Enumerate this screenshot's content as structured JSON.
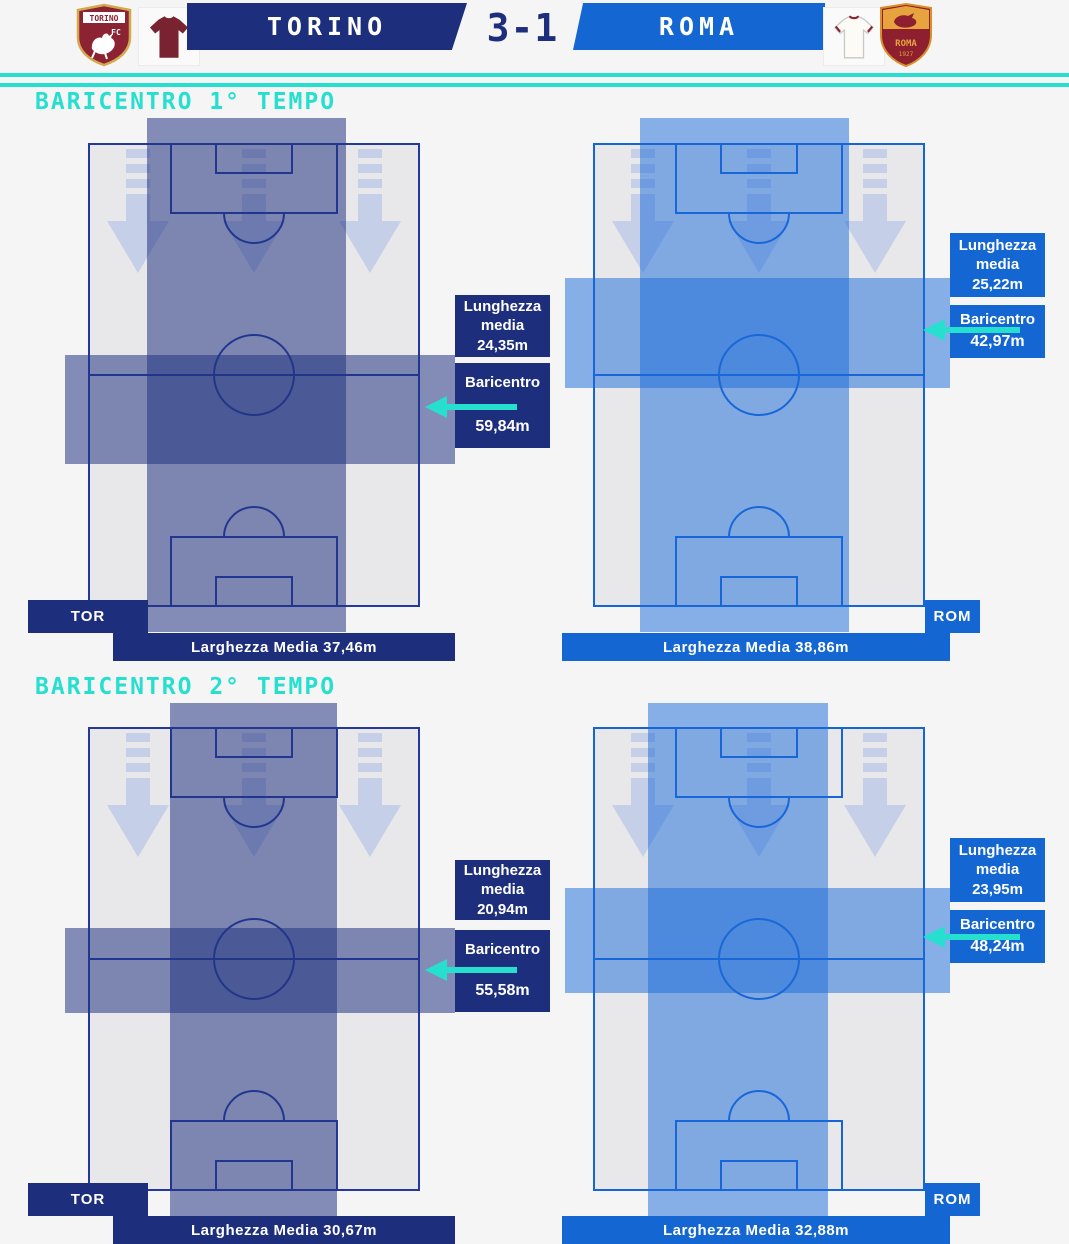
{
  "colors": {
    "navy": "#1d2e7d",
    "roma_blue": "#1467d2",
    "cyan": "#26dfce",
    "torino_maroon": "#7a2330",
    "roma_maroon": "#8e1f2f",
    "pitch_gray": "#e8e8ea"
  },
  "header": {
    "home_name": "TORINO",
    "away_name": "ROMA",
    "score": "3-1"
  },
  "sections": [
    {
      "title": "BARICENTRO 1° TEMPO",
      "panels": [
        {
          "team_abbr": "TOR",
          "lunghezza_line1": "Lunghezza",
          "lunghezza_line2": "media 24,35m",
          "baricentro_label": "Baricentro",
          "baricentro_value": "59,84m",
          "larghezza_label": "Larghezza Media 37,46m"
        },
        {
          "team_abbr": "ROM",
          "lunghezza_line1": "Lunghezza",
          "lunghezza_line2": "media 25,22m",
          "baricentro_label": "Baricentro",
          "baricentro_value": "42,97m",
          "larghezza_label": "Larghezza Media 38,86m"
        }
      ]
    },
    {
      "title": "BARICENTRO 2° TEMPO",
      "panels": [
        {
          "team_abbr": "TOR",
          "lunghezza_line1": "Lunghezza",
          "lunghezza_line2": "media 20,94m",
          "baricentro_label": "Baricentro",
          "baricentro_value": "55,58m",
          "larghezza_label": "Larghezza Media 30,67m"
        },
        {
          "team_abbr": "ROM",
          "lunghezza_line1": "Lunghezza",
          "lunghezza_line2": "media 23,95m",
          "baricentro_label": "Baricentro",
          "baricentro_value": "48,24m",
          "larghezza_label": "Larghezza Media 32,88m"
        }
      ]
    }
  ],
  "crest_home_text": "TORINO FC",
  "crest_away_text": "ROMA",
  "crest_away_year": "1927",
  "chart_data": {
    "type": "table",
    "title": "Baricentro Torino vs Roma (3-1)",
    "periods": [
      {
        "period": "1° Tempo",
        "teams": [
          {
            "team": "Torino",
            "lunghezza_media_m": 24.35,
            "baricentro_m": 59.84,
            "larghezza_media_m": 37.46
          },
          {
            "team": "Roma",
            "lunghezza_media_m": 25.22,
            "baricentro_m": 42.97,
            "larghezza_media_m": 38.86
          }
        ]
      },
      {
        "period": "2° Tempo",
        "teams": [
          {
            "team": "Torino",
            "lunghezza_media_m": 20.94,
            "baricentro_m": 55.58,
            "larghezza_media_m": 30.67
          },
          {
            "team": "Roma",
            "lunghezza_media_m": 23.95,
            "baricentro_m": 48.24,
            "larghezza_media_m": 32.88
          }
        ]
      }
    ]
  }
}
